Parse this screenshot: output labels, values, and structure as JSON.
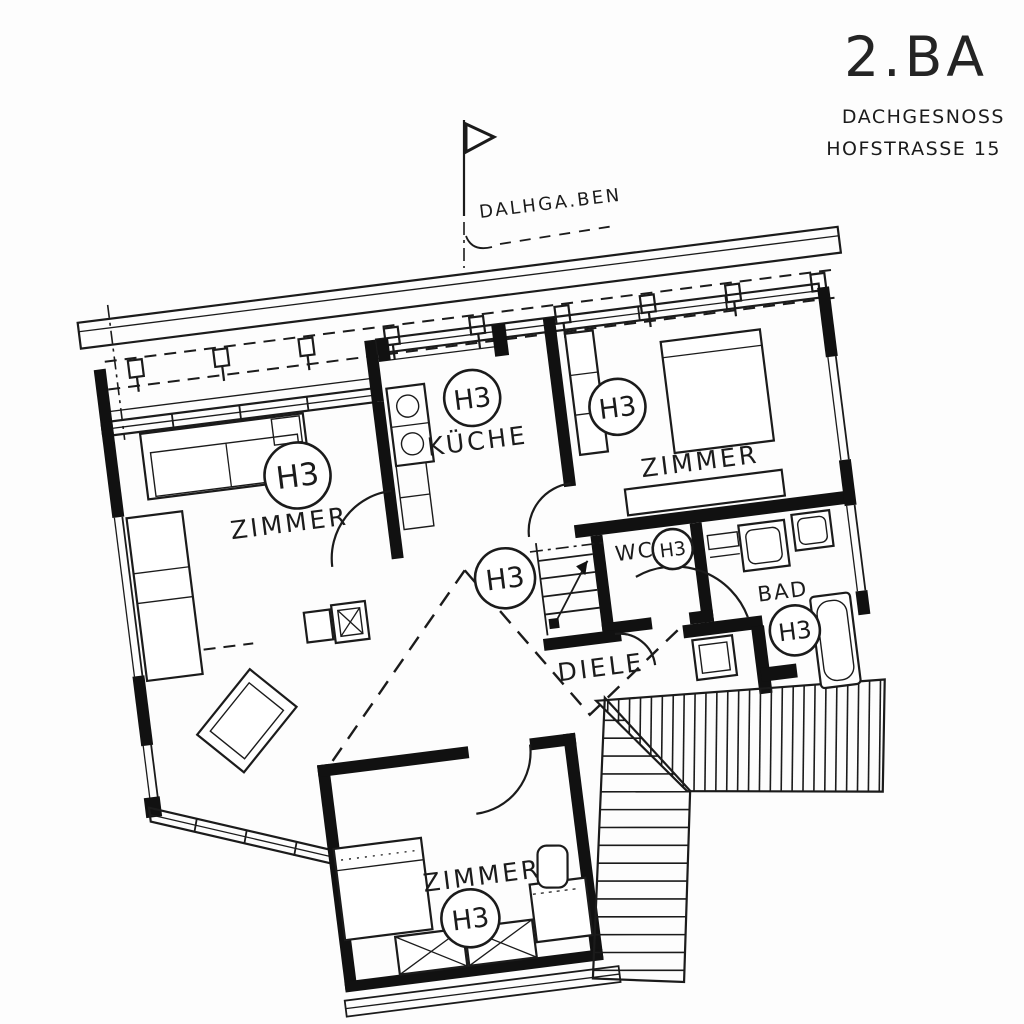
{
  "title_block": {
    "project": "2.BA",
    "line1": "DACHGESNOSS",
    "line2": "HOFSTRASSE 15"
  },
  "north_annotation": {
    "label": "DALHGA.BEN"
  },
  "unit_tag": "H3",
  "rooms": {
    "zimmer_left": {
      "name": "ZIMMER",
      "tag": "H3"
    },
    "kueche": {
      "name": "KÜCHE",
      "tag": "H3"
    },
    "zimmer_right": {
      "name": "ZIMMER",
      "tag": "H3"
    },
    "wc": {
      "name": "WC",
      "tag": "H3"
    },
    "bad": {
      "name": "BAD",
      "tag": "H3"
    },
    "diele": {
      "name": "DIELE",
      "tag": "H3"
    },
    "zimmer_bottom": {
      "name": "ZIMMER",
      "tag": "H3"
    }
  },
  "colors": {
    "ink": "#1b1b1b",
    "paper": "#fdfdfd"
  }
}
